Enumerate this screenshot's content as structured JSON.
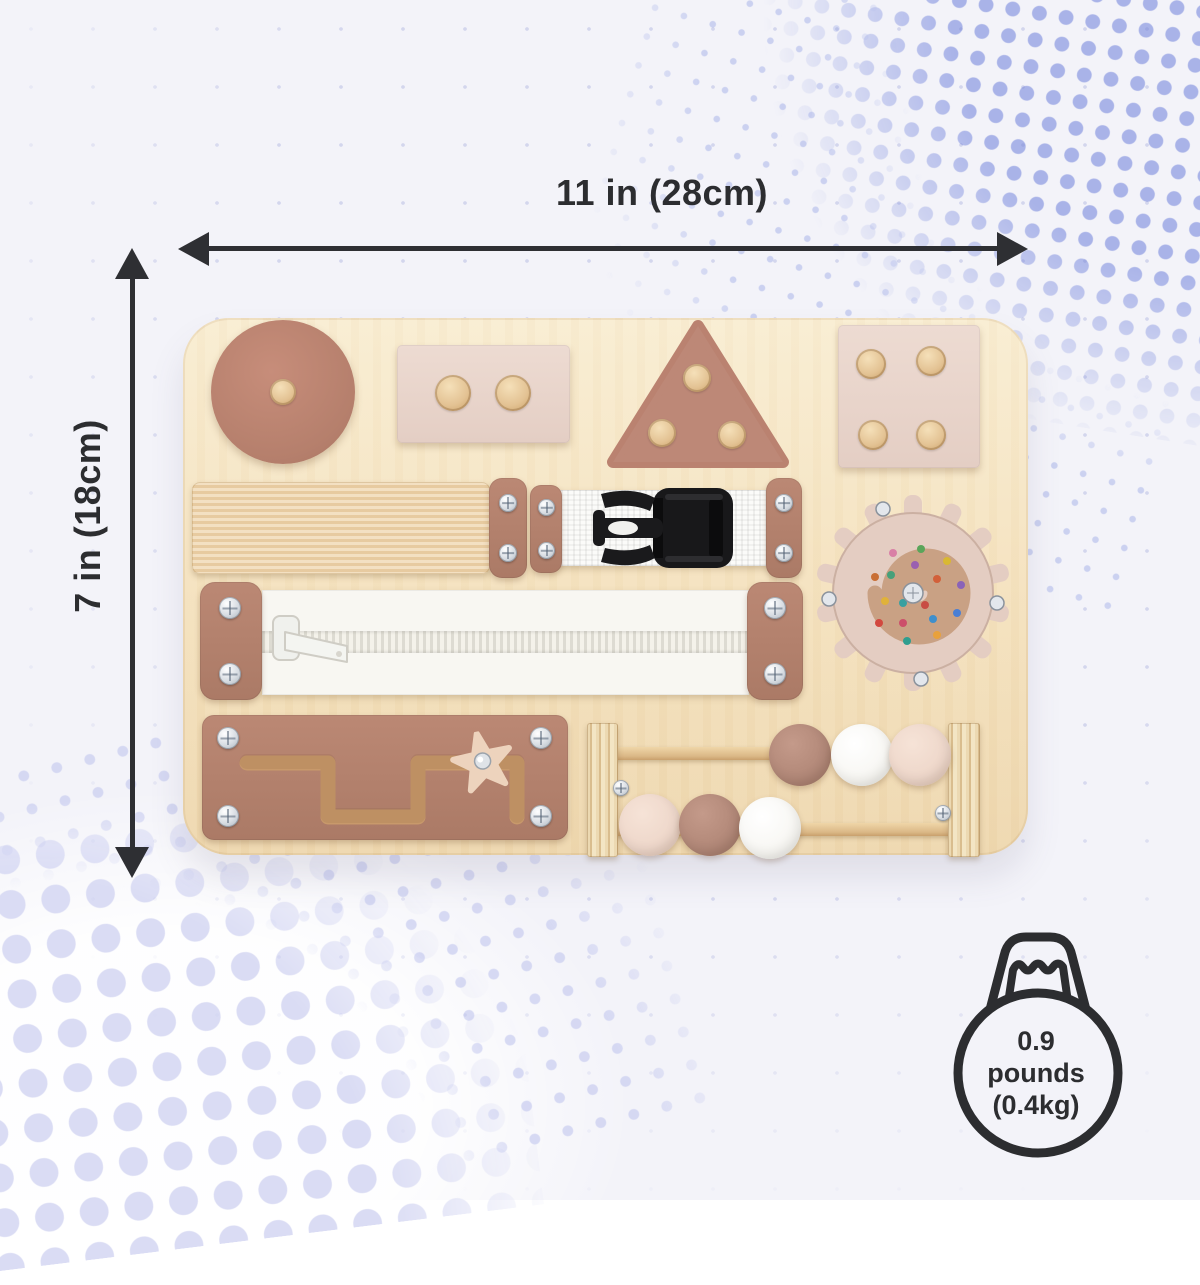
{
  "annotations": {
    "width_label": "11 in (28cm)",
    "height_label": "7 in (18cm)"
  },
  "weight_badge": {
    "value": "0.9",
    "unit": "pounds",
    "metric": "(0.4kg)",
    "icon": "kettlebell-weight-icon",
    "outline_color": "#2c2d30"
  },
  "product": {
    "type": "wooden-montessori-busy-board",
    "board_color": "#f5e3c0",
    "elements": [
      {
        "name": "circle-shape",
        "color": "#bf8170",
        "pegs": 1
      },
      {
        "name": "rectangle-shape",
        "color": "#e9d6cc",
        "pegs": 2
      },
      {
        "name": "triangle-shape",
        "color": "#bf8170",
        "pegs": 3
      },
      {
        "name": "square-shape",
        "color": "#e9d6cc",
        "pegs": 4
      },
      {
        "name": "elastic-strap",
        "color": "#efd4ab"
      },
      {
        "name": "buckle-strap",
        "webbing_color": "#ffffff",
        "buckle_color": "#1a1a1c"
      },
      {
        "name": "zipper",
        "tape_color": "#f8f7f2"
      },
      {
        "name": "gear-bead-spiral",
        "color": "#e4cdc2",
        "bead_colors": [
          "#d2483f",
          "#2f9e8f",
          "#e8a13c",
          "#4a7fd4",
          "#8a63b8",
          "#d9b832",
          "#5aa55a",
          "#d97fa6"
        ]
      },
      {
        "name": "slide-maze-with-star",
        "plate_color": "#b5806c",
        "star_color": "#edd3bd"
      },
      {
        "name": "bead-abacus",
        "bead_colors": [
          "#b28878",
          "#fbfbf9",
          "#eed7ca"
        ]
      }
    ]
  },
  "style": {
    "background": "#f3f3f9",
    "halftone_dot_color": "#a9b3e8",
    "halftone_dot_color_light": "#dadcf4",
    "annotation_color": "#2c2d30"
  }
}
